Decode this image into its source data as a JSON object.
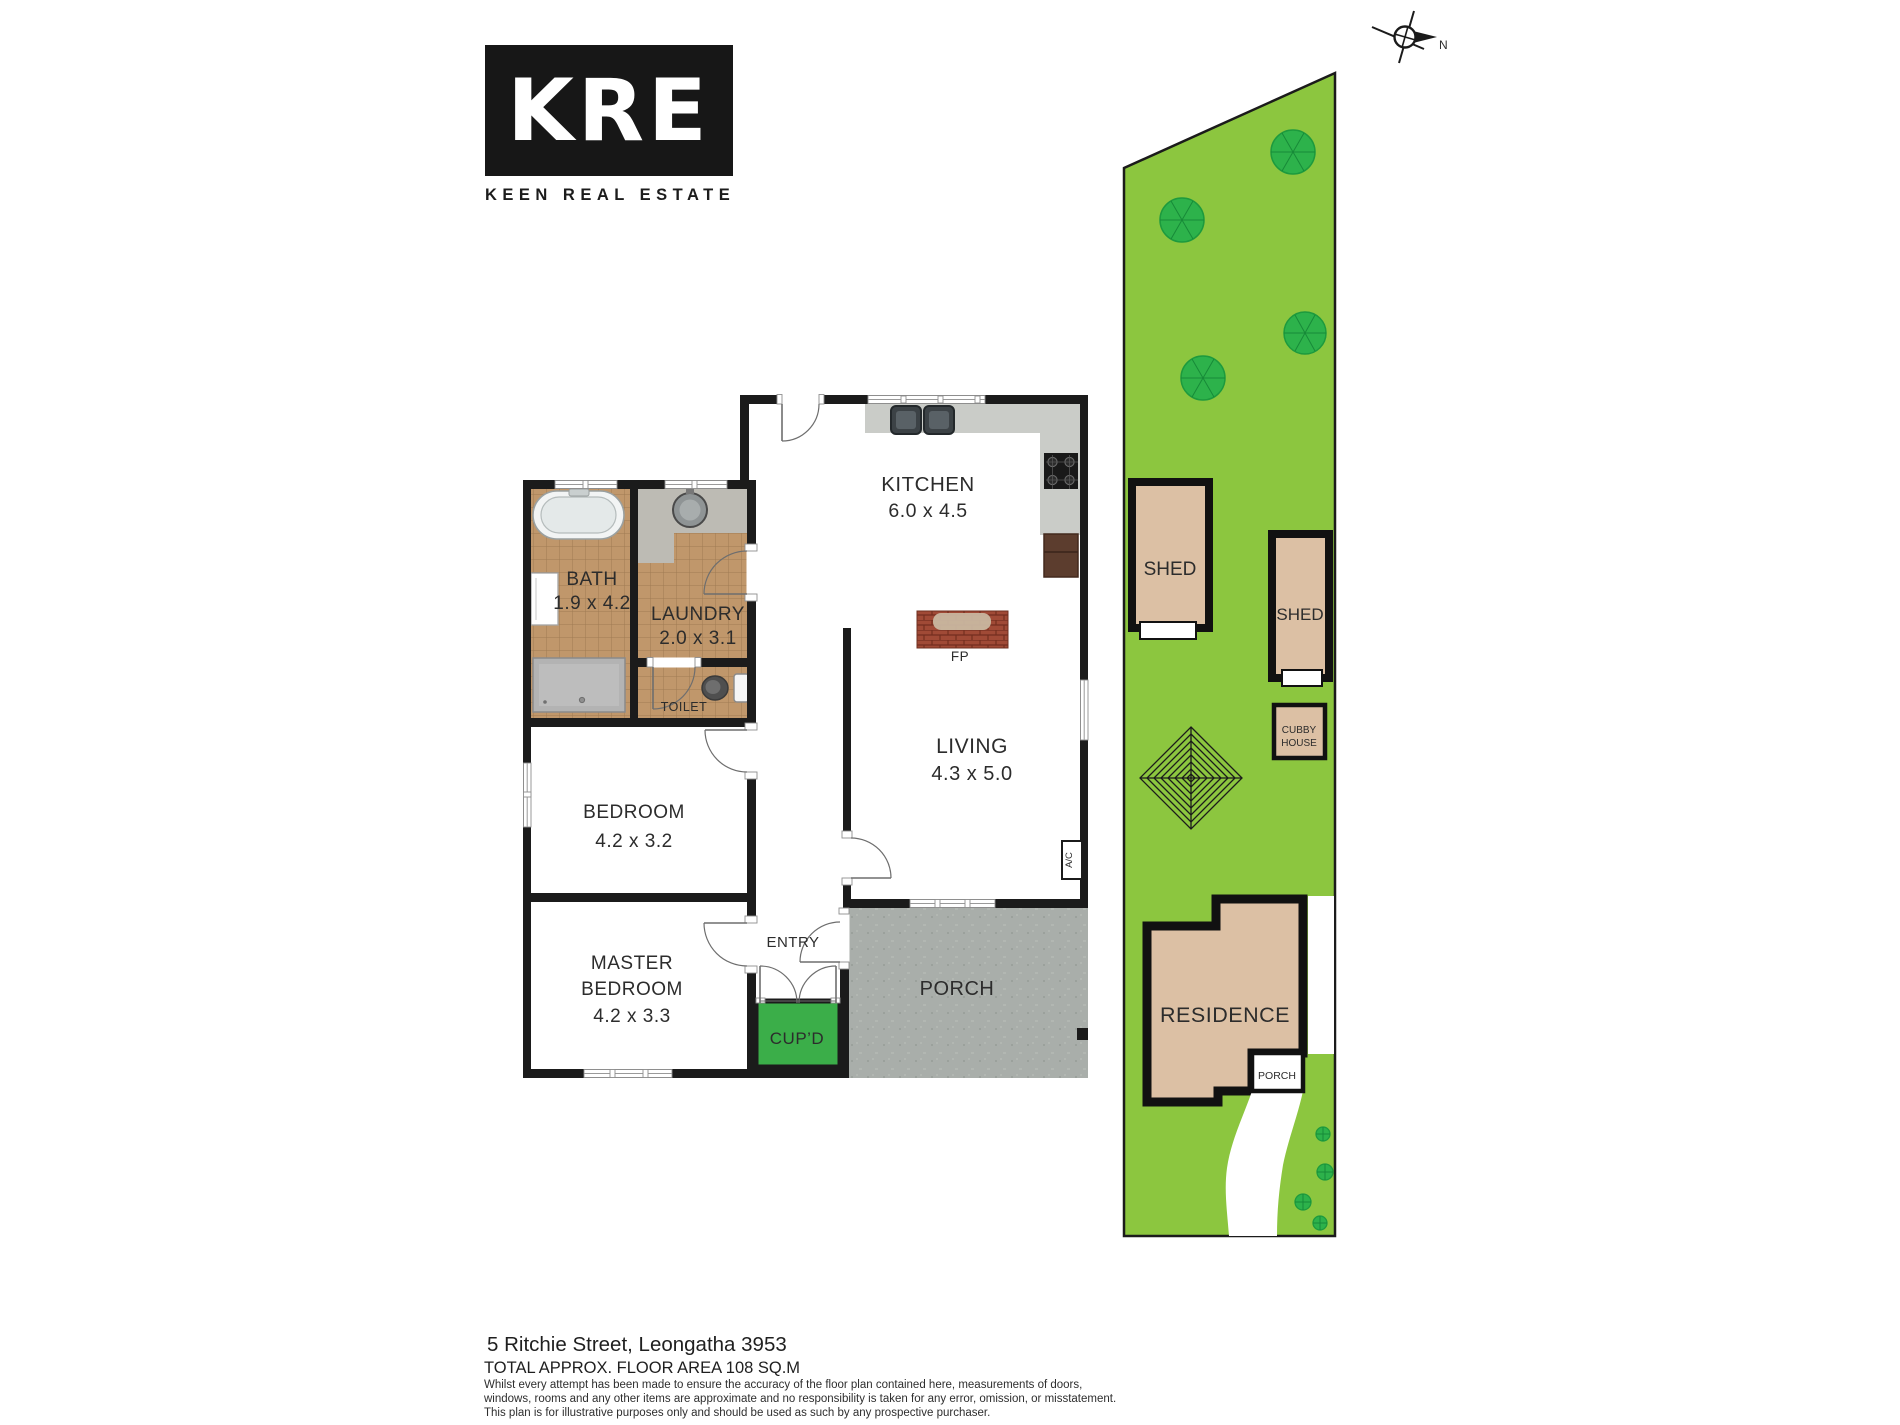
{
  "logo": {
    "mark": "KRE",
    "name": "KEEN REAL ESTATE"
  },
  "compass": {
    "north": "N"
  },
  "floorplan": {
    "kitchen": {
      "name": "KITCHEN",
      "dims": "6.0 x 4.5"
    },
    "bath": {
      "name": "BATH",
      "dims": "1.9 x 4.2"
    },
    "laundry": {
      "name": "LAUNDRY",
      "dims": "2.0 x 3.1"
    },
    "toilet": {
      "name": "TOILET"
    },
    "bedroom": {
      "name": "BEDROOM",
      "dims": "4.2 x 3.2"
    },
    "master": {
      "line1": "MASTER",
      "line2": "BEDROOM",
      "dims": "4.2 x 3.3"
    },
    "living": {
      "name": "LIVING",
      "dims": "4.3 x 5.0"
    },
    "entry": {
      "name": "ENTRY"
    },
    "cupd": {
      "name": "CUP’D"
    },
    "porch": {
      "name": "PORCH"
    },
    "fireplace": {
      "name": "FP"
    },
    "ac": {
      "name": "A/C"
    }
  },
  "site": {
    "shed_large": {
      "name": "SHED"
    },
    "shed_small": {
      "name": "SHED"
    },
    "cubby": {
      "line1": "CUBBY",
      "line2": "HOUSE"
    },
    "residence": {
      "name": "RESIDENCE"
    },
    "porch": {
      "name": "PORCH"
    }
  },
  "footer": {
    "address": "5 Ritchie Street, Leongatha 3953",
    "area": "TOTAL APPROX. FLOOR AREA 108 SQ.M",
    "disclaimer_line1": "Whilst every attempt has been made to ensure the accuracy of the floor plan contained here, measurements of doors,",
    "disclaimer_line2": "windows, rooms and any other items are approximate and no responsibility is taken for any error, omission, or misstatement.",
    "disclaimer_line3": "This plan is for illustrative purposes only and should be used as such by any prospective purchaser."
  },
  "colors": {
    "wall": "#1b1b1b",
    "site_green": "#8cc63f",
    "tree_green": "#2db24b",
    "tan": "#dcc0a4",
    "cupboard_green": "#3bae49",
    "tile": "#c0976b",
    "porch_gray": "#a9aeaa",
    "counter_gray": "#caccc8",
    "brick": "#a04a36"
  }
}
